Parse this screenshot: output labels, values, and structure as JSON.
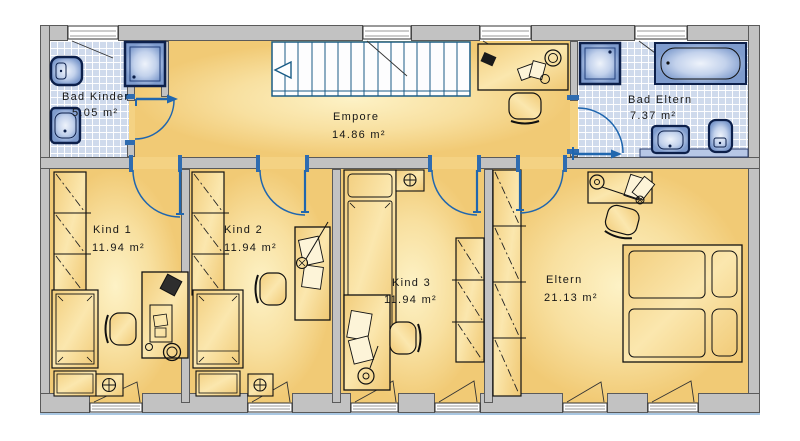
{
  "rooms": [
    {
      "key": "bad-kinder",
      "label": "Bad Kinder",
      "area": "5.05 m²"
    },
    {
      "key": "empore",
      "label": "Empore",
      "area": "14.86 m²"
    },
    {
      "key": "bad-eltern",
      "label": "Bad Eltern",
      "area": "7.37 m²"
    },
    {
      "key": "kind-1",
      "label": "Kind 1",
      "area": "11.94 m²"
    },
    {
      "key": "kind-2",
      "label": "Kind 2",
      "area": "11.94 m²"
    },
    {
      "key": "kind-3",
      "label": "Kind 3",
      "area": "11.94 m²"
    },
    {
      "key": "eltern",
      "label": "Eltern",
      "area": "21.13 m²"
    }
  ],
  "stairs": {
    "direction_arrow": "left"
  },
  "colors": {
    "wall": "#c2c2c2",
    "wall_outline": "#5a5a5a",
    "floor": "#f4d283",
    "floor_glow": "#fdf2c6",
    "tile": "#cfdaec",
    "fixture_blue": "#8aa5d3",
    "door_blue": "#2066ae",
    "stair_teal": "#1a5c86",
    "window_sill_blue": "#a9c7e2",
    "text": "#161616"
  }
}
